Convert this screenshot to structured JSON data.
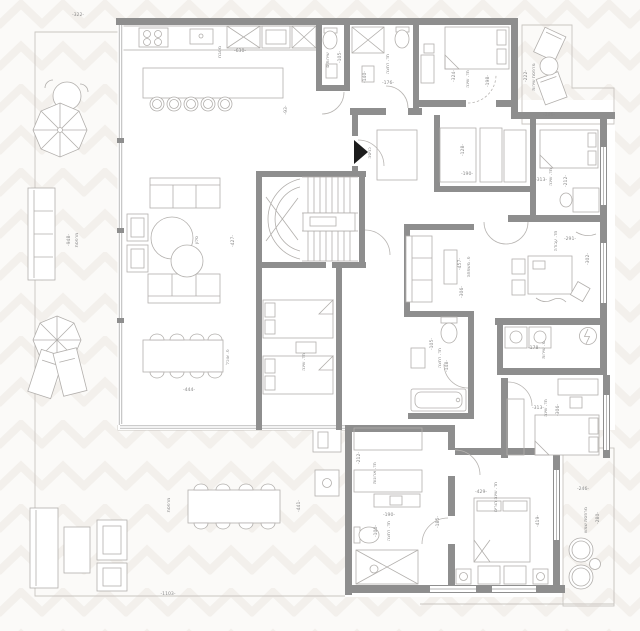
{
  "plan": {
    "colors": {
      "background": "#fbfaf8",
      "pattern_watermark": "#f3f0ec",
      "wall": "#8e8e8e",
      "furniture_line": "#b2afac",
      "deck_line": "#dcd8d3",
      "label_text": "#8a8a8a",
      "entrance_marker": "#1c1c1c"
    },
    "room_names": [
      "מטבח",
      "סלון",
      "פ. אוכל",
      "מרפסת",
      "שירותים",
      "חד. רחצה",
      "חד. שינה",
      "חד. ארונות",
      "חד. עבודה",
      "פ. משפחה",
      "מ. שירות",
      "חד. שינה הורים",
      "מרפסת שמש",
      "מרפסת שירות",
      "כניסה"
    ],
    "labels": [
      {
        "text": "-322-",
        "x": 78,
        "y": 16,
        "rot": 0,
        "kind": "dimension"
      },
      {
        "text": "מטבח",
        "x": 221,
        "y": 52,
        "rot": 90,
        "kind": "room"
      },
      {
        "text": "-630-",
        "x": 240,
        "y": 52,
        "rot": 0,
        "kind": "dimension"
      },
      {
        "text": "-93-",
        "x": 287,
        "y": 110,
        "rot": 90,
        "kind": "dimension"
      },
      {
        "text": "סלון",
        "x": 198,
        "y": 240,
        "rot": 90,
        "kind": "room"
      },
      {
        "text": "-427-",
        "x": 234,
        "y": 241,
        "rot": 90,
        "kind": "dimension"
      },
      {
        "text": "פ. אוכל",
        "x": 229,
        "y": 357,
        "rot": 90,
        "kind": "room"
      },
      {
        "text": "-444-",
        "x": 189,
        "y": 391,
        "rot": 0,
        "kind": "dimension"
      },
      {
        "text": "מרפסת",
        "x": 78,
        "y": 240,
        "rot": 90,
        "kind": "room"
      },
      {
        "text": "-948-",
        "x": 70,
        "y": 240,
        "rot": 90,
        "kind": "dimension"
      },
      {
        "text": "מרפסת",
        "x": 170,
        "y": 505,
        "rot": 90,
        "kind": "room"
      },
      {
        "text": "-441-",
        "x": 300,
        "y": 506,
        "rot": 90,
        "kind": "dimension"
      },
      {
        "text": "-1103-",
        "x": 168,
        "y": 595,
        "rot": 0,
        "kind": "dimension"
      },
      {
        "text": "שירותים",
        "x": 329,
        "y": 60,
        "rot": 90,
        "kind": "room"
      },
      {
        "text": "-105-",
        "x": 341,
        "y": 57,
        "rot": 90,
        "kind": "dimension"
      },
      {
        "text": "-140-",
        "x": 366,
        "y": 77,
        "rot": 90,
        "kind": "dimension"
      },
      {
        "text": "חד. רחצה",
        "x": 389,
        "y": 64,
        "rot": 90,
        "kind": "room"
      },
      {
        "text": "-176-",
        "x": 388,
        "y": 84,
        "rot": 0,
        "kind": "dimension"
      },
      {
        "text": "-324-",
        "x": 455,
        "y": 76,
        "rot": 90,
        "kind": "dimension"
      },
      {
        "text": "חד. שינה",
        "x": 469,
        "y": 79,
        "rot": 90,
        "kind": "room"
      },
      {
        "text": "-198-",
        "x": 489,
        "y": 81,
        "rot": 90,
        "kind": "dimension"
      },
      {
        "text": "-222-",
        "x": 527,
        "y": 76,
        "rot": 90,
        "kind": "dimension"
      },
      {
        "text": "מרפסת שירות",
        "x": 535,
        "y": 77,
        "rot": 90,
        "kind": "room"
      },
      {
        "text": "-246-",
        "x": 549,
        "y": 116,
        "rot": 0,
        "kind": "dimension"
      },
      {
        "text": "-128-",
        "x": 464,
        "y": 150,
        "rot": 90,
        "kind": "dimension"
      },
      {
        "text": "-190-",
        "x": 467,
        "y": 175,
        "rot": 0,
        "kind": "dimension"
      },
      {
        "text": "-313-",
        "x": 541,
        "y": 181,
        "rot": 0,
        "kind": "dimension"
      },
      {
        "text": "חד. שינה",
        "x": 552,
        "y": 177,
        "rot": 90,
        "kind": "room"
      },
      {
        "text": "-212-",
        "x": 567,
        "y": 181,
        "rot": 90,
        "kind": "dimension"
      },
      {
        "text": "חד. עבודה",
        "x": 557,
        "y": 241,
        "rot": 90,
        "kind": "room"
      },
      {
        "text": "-291-",
        "x": 570,
        "y": 240,
        "rot": 0,
        "kind": "dimension"
      },
      {
        "text": "-302-",
        "x": 589,
        "y": 259,
        "rot": 90,
        "kind": "dimension"
      },
      {
        "text": "-457-",
        "x": 461,
        "y": 264,
        "rot": 90,
        "kind": "dimension"
      },
      {
        "text": "פ. משפחה",
        "x": 470,
        "y": 267,
        "rot": 90,
        "kind": "room"
      },
      {
        "text": "-306-",
        "x": 463,
        "y": 292,
        "rot": 90,
        "kind": "dimension"
      },
      {
        "text": "-178-",
        "x": 534,
        "y": 349,
        "rot": 0,
        "kind": "dimension"
      },
      {
        "text": "מ. שירות",
        "x": 545,
        "y": 350,
        "rot": 90,
        "kind": "room"
      },
      {
        "text": "-105-",
        "x": 433,
        "y": 344,
        "rot": 90,
        "kind": "dimension"
      },
      {
        "text": "חד. רחצה",
        "x": 441,
        "y": 358,
        "rot": 90,
        "kind": "room"
      },
      {
        "text": "-148-",
        "x": 448,
        "y": 366,
        "rot": 90,
        "kind": "dimension"
      },
      {
        "text": "חד. שינה",
        "x": 305,
        "y": 362,
        "rot": 90,
        "kind": "room"
      },
      {
        "text": "-212-",
        "x": 360,
        "y": 458,
        "rot": 90,
        "kind": "dimension"
      },
      {
        "text": "חד. ארונות",
        "x": 376,
        "y": 473,
        "rot": 90,
        "kind": "room"
      },
      {
        "text": "-190-",
        "x": 389,
        "y": 516,
        "rot": 0,
        "kind": "dimension"
      },
      {
        "text": "-100-",
        "x": 377,
        "y": 531,
        "rot": 90,
        "kind": "dimension"
      },
      {
        "text": "חד. רחצה",
        "x": 390,
        "y": 531,
        "rot": 90,
        "kind": "room"
      },
      {
        "text": "-313-",
        "x": 538,
        "y": 409,
        "rot": 0,
        "kind": "dimension"
      },
      {
        "text": "חד. שינה",
        "x": 547,
        "y": 408,
        "rot": 90,
        "kind": "room"
      },
      {
        "text": "-306-",
        "x": 559,
        "y": 410,
        "rot": 90,
        "kind": "dimension"
      },
      {
        "text": "-429-",
        "x": 481,
        "y": 493,
        "rot": 0,
        "kind": "dimension"
      },
      {
        "text": "חד. שינה הורים",
        "x": 497,
        "y": 497,
        "rot": 90,
        "kind": "room"
      },
      {
        "text": "-419-",
        "x": 539,
        "y": 521,
        "rot": 90,
        "kind": "dimension"
      },
      {
        "text": "-185-",
        "x": 439,
        "y": 522,
        "rot": 90,
        "kind": "dimension"
      },
      {
        "text": "-246-",
        "x": 583,
        "y": 490,
        "rot": 0,
        "kind": "dimension"
      },
      {
        "text": "מרפסת שמש",
        "x": 587,
        "y": 520,
        "rot": 90,
        "kind": "room"
      },
      {
        "text": "-280-",
        "x": 599,
        "y": 518,
        "rot": 90,
        "kind": "dimension"
      },
      {
        "text": "כניסה",
        "x": 371,
        "y": 153,
        "rot": 90,
        "kind": "room"
      }
    ]
  }
}
